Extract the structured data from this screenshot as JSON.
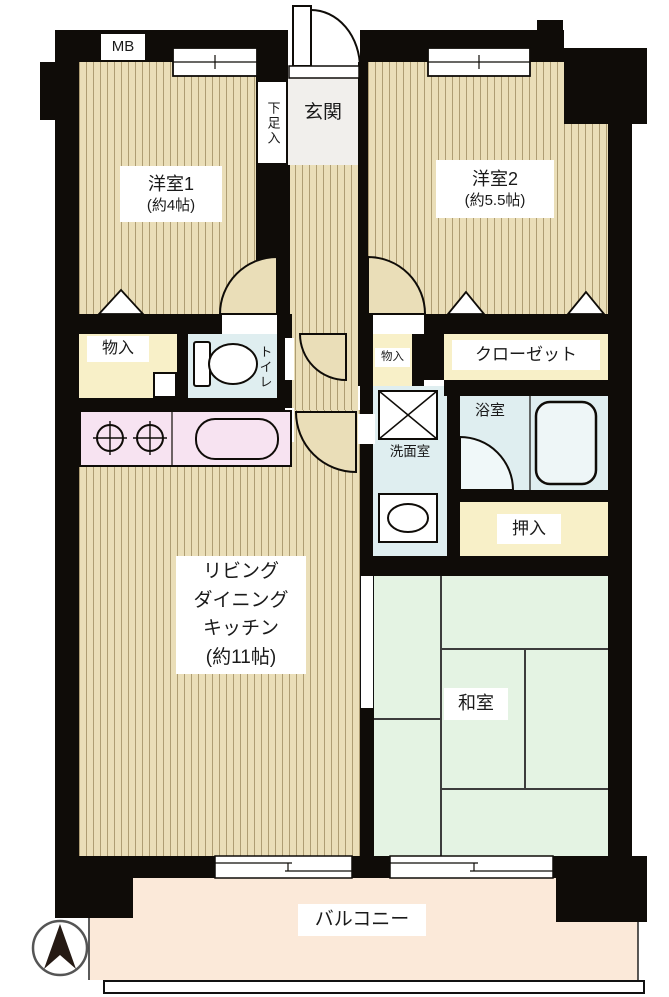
{
  "meter_box": "MB",
  "entrance": {
    "label": "玄関",
    "shoe_storage": "下足入"
  },
  "rooms": {
    "western1_name": "洋室1",
    "western1_size": "(約4帖)",
    "western2_name": "洋室2",
    "western2_size": "(約5.5帖)",
    "ldk": [
      "リビング",
      "ダイニング",
      "キッチン",
      "(約11帖)"
    ],
    "japanese": "和室",
    "toilet": "トイレ",
    "washroom": "洗面室",
    "bathroom": "浴室",
    "closet": "クローゼット",
    "oshiire": "押入",
    "storage_left": "物入",
    "storage_center": "物入",
    "balcony": "バルコニー"
  },
  "icons": {
    "compass": "north-arrow-compass",
    "stove": "two-burner-stove",
    "sink": "kitchen-sink",
    "toilet": "toilet-bowl",
    "bathtub": "bathtub",
    "washer_pan": "washing-machine-pan",
    "basin": "wash-basin"
  },
  "colors": {
    "wall": "#0f0c08",
    "wood_floor": "#eadeb8",
    "tatami": "#e4f3e3",
    "wet_area": "#dfeef0",
    "kitchen_counter": "#f7e3f1",
    "storage": "#f8f0c8",
    "balcony": "#fbe9d9"
  }
}
